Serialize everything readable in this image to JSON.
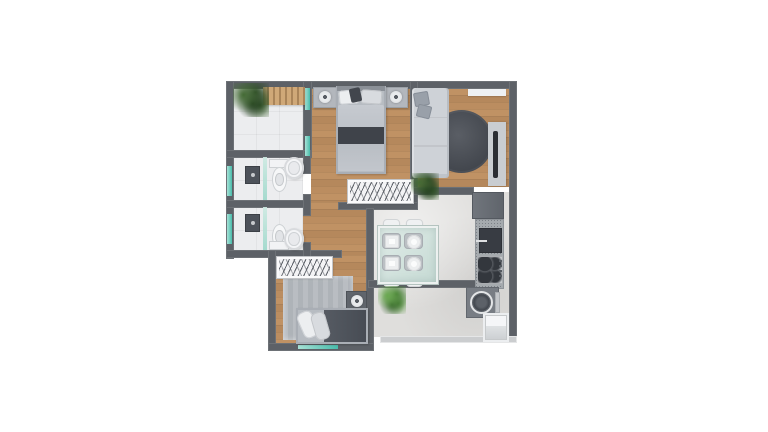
{
  "scene": {
    "background": "#ffffff",
    "kind": "apartment-floor-plan-3d-top-view"
  },
  "palette": {
    "wall": "#5d6167",
    "wall-light": "#cbcdcf",
    "wood-a": "#c09264",
    "wood-b": "#b5885c",
    "wood-c": "#bb8d60",
    "tile-white": "#ecedef",
    "tile-kitchen": "#dfdedc",
    "glass-a": "#a7e2d6",
    "glass-b": "#49bcac",
    "rug-dark-a": "#5a5e65",
    "rug-dark-b": "#41454c",
    "rug-light": "#b9bdc2",
    "sofa": "#ced2d7",
    "cushion": "#99a0a9",
    "bed-frame": "#b7bcc2",
    "bed-throw": "#3f434a",
    "bed2-duvet": "#565b63",
    "counter": "#a5aaae",
    "glass-table": "#c6dad4"
  },
  "rooms": [
    {
      "id": "balcony"
    },
    {
      "id": "bedroom-1"
    },
    {
      "id": "living-room"
    },
    {
      "id": "bathroom-1"
    },
    {
      "id": "bathroom-2"
    },
    {
      "id": "hallway"
    },
    {
      "id": "bedroom-2"
    },
    {
      "id": "kitchen-dining"
    },
    {
      "id": "service-area"
    }
  ],
  "plan": {
    "items": [
      {
        "id": "balcony-floor",
        "t": "floor-tile-white",
        "x": 233,
        "y": 88,
        "w": 72,
        "h": 64,
        "z": 1
      },
      {
        "id": "bathroom-1-floor",
        "t": "floor-tile-white",
        "x": 233,
        "y": 157,
        "w": 70,
        "h": 44,
        "z": 1
      },
      {
        "id": "bathroom-2-floor",
        "t": "floor-tile-white",
        "x": 233,
        "y": 207,
        "w": 70,
        "h": 44,
        "z": 1
      },
      {
        "id": "bedroom-1-floor",
        "t": "floor-wood",
        "x": 311,
        "y": 88,
        "w": 100,
        "h": 116,
        "z": 1
      },
      {
        "id": "living-room-floor",
        "t": "floor-wood",
        "x": 417,
        "y": 88,
        "w": 93,
        "h": 99,
        "z": 1
      },
      {
        "id": "hallway-floor",
        "t": "floor-wood",
        "x": 303,
        "y": 202,
        "w": 64,
        "h": 60,
        "z": 1
      },
      {
        "id": "bedroom-2-floor",
        "t": "floor-wood",
        "x": 275,
        "y": 255,
        "w": 92,
        "h": 90,
        "z": 1
      },
      {
        "id": "kitchen-floor",
        "t": "floor-tile-kitchen",
        "x": 374,
        "y": 192,
        "w": 136,
        "h": 145,
        "z": 1
      },
      {
        "id": "living-rug",
        "t": "rug-round",
        "x": 430,
        "y": 110,
        "w": 63,
        "h": 63,
        "r": "50%",
        "z": 2
      },
      {
        "id": "bedroom-2-rug",
        "t": "rug-flat",
        "x": 283,
        "y": 276,
        "w": 70,
        "h": 64,
        "z": 2
      },
      {
        "id": "wall-top",
        "t": "wall",
        "x": 226,
        "y": 81,
        "w": 291,
        "h": 8,
        "z": 3
      },
      {
        "id": "wall-left",
        "t": "wall",
        "x": 226,
        "y": 81,
        "w": 8,
        "h": 178,
        "z": 3
      },
      {
        "id": "wall-right",
        "t": "wall",
        "x": 509,
        "y": 81,
        "w": 8,
        "h": 262,
        "z": 3
      },
      {
        "id": "wall-balcony-divider",
        "t": "wall",
        "x": 303,
        "y": 81,
        "w": 9,
        "h": 77,
        "z": 3
      },
      {
        "id": "wall-balcony-bottom",
        "t": "wall",
        "x": 226,
        "y": 150,
        "w": 86,
        "h": 8,
        "z": 3
      },
      {
        "id": "wall-bath-divider",
        "t": "wall",
        "x": 226,
        "y": 200,
        "w": 84,
        "h": 8,
        "z": 3
      },
      {
        "id": "wall-bath2-bottom",
        "t": "wall",
        "x": 226,
        "y": 250,
        "w": 116,
        "h": 8,
        "z": 3
      },
      {
        "id": "wall-bath-right-a",
        "t": "wall",
        "x": 303,
        "y": 150,
        "w": 8,
        "h": 24,
        "z": 3
      },
      {
        "id": "wall-bath-right-b",
        "t": "wall",
        "x": 303,
        "y": 194,
        "w": 8,
        "h": 22,
        "z": 3
      },
      {
        "id": "wall-bath-right-c",
        "t": "wall",
        "x": 303,
        "y": 242,
        "w": 8,
        "h": 16,
        "z": 3
      },
      {
        "id": "wall-bedroom1-right",
        "t": "wall",
        "x": 410,
        "y": 81,
        "w": 8,
        "h": 129,
        "z": 3
      },
      {
        "id": "wall-bedroom1-bottom",
        "t": "wall",
        "x": 338,
        "y": 202,
        "w": 80,
        "h": 8,
        "z": 3
      },
      {
        "id": "wall-bedroom2-right",
        "t": "wall",
        "x": 366,
        "y": 208,
        "w": 8,
        "h": 143,
        "z": 3
      },
      {
        "id": "wall-bedroom2-left",
        "t": "wall",
        "x": 268,
        "y": 250,
        "w": 8,
        "h": 101,
        "z": 3
      },
      {
        "id": "wall-living-step",
        "t": "wall",
        "x": 412,
        "y": 187,
        "w": 62,
        "h": 8,
        "z": 3
      },
      {
        "id": "wall-kitchen-band",
        "t": "wall",
        "x": 368,
        "y": 280,
        "w": 110,
        "h": 8,
        "z": 3
      },
      {
        "id": "wall-bedroom2-bottom",
        "t": "wall",
        "x": 268,
        "y": 343,
        "w": 106,
        "h": 8,
        "z": 3
      },
      {
        "id": "wall-kitchen-bottom",
        "t": "wall-light",
        "x": 380,
        "y": 336,
        "w": 137,
        "h": 7,
        "z": 3
      },
      {
        "id": "bathroom-1-window",
        "t": "window-glass",
        "x": 227,
        "y": 166,
        "w": 5,
        "h": 30,
        "z": 4
      },
      {
        "id": "bathroom-2-window",
        "t": "window-glass",
        "x": 227,
        "y": 214,
        "w": 5,
        "h": 30,
        "z": 4
      },
      {
        "id": "bedroom-1-window-upper",
        "t": "window-glass",
        "x": 305,
        "y": 88,
        "w": 5,
        "h": 22,
        "z": 4
      },
      {
        "id": "bedroom-1-window-lower",
        "t": "window-glass",
        "x": 305,
        "y": 136,
        "w": 5,
        "h": 20,
        "z": 4
      },
      {
        "id": "bedroom-2-window",
        "t": "window-glass",
        "x": 298,
        "y": 345,
        "w": 40,
        "h": 4,
        "z": 4
      },
      {
        "id": "balcony-bench",
        "t": "bench-slats",
        "x": 263,
        "y": 87,
        "w": 42,
        "h": 18,
        "z": 5
      },
      {
        "id": "balcony-plant",
        "t": "plant-dark",
        "x": 233,
        "y": 83,
        "w": 36,
        "h": 34,
        "z": 5
      },
      {
        "id": "bedroom-1-nightstand-left",
        "t": "nightstand",
        "x": 313,
        "y": 87,
        "w": 24,
        "h": 21,
        "z": 5
      },
      {
        "id": "bedroom-1-lamp-left",
        "t": "lamp",
        "x": 319,
        "y": 91,
        "w": 12,
        "h": 12,
        "z": 6
      },
      {
        "id": "bedroom-1-nightstand-right",
        "t": "nightstand",
        "x": 384,
        "y": 87,
        "w": 24,
        "h": 21,
        "z": 5
      },
      {
        "id": "bedroom-1-lamp-right",
        "t": "lamp",
        "x": 390,
        "y": 91,
        "w": 12,
        "h": 12,
        "z": 6
      },
      {
        "id": "bedroom-1-bed",
        "t": "bed-frame",
        "x": 336,
        "y": 86,
        "w": 50,
        "h": 88,
        "z": 5
      },
      {
        "id": "bedroom-1-bed-headboard",
        "t": "headboard",
        "x": 337,
        "y": 86,
        "w": 48,
        "h": 5,
        "z": 6
      },
      {
        "id": "bedroom-1-pillow-left",
        "t": "pillow",
        "x": 339,
        "y": 90,
        "w": 20,
        "h": 14,
        "r": 3,
        "rot": -5,
        "z": 6
      },
      {
        "id": "bedroom-1-pillow-right",
        "t": "pillow-gray",
        "x": 361,
        "y": 90,
        "w": 21,
        "h": 14,
        "r": 3,
        "rot": 4,
        "z": 6
      },
      {
        "id": "bedroom-1-pillow-accent",
        "t": "pillow-dark",
        "x": 350,
        "y": 88,
        "w": 11,
        "h": 14,
        "r": 2,
        "rot": -12,
        "z": 7
      },
      {
        "id": "bedroom-1-duvet",
        "t": "duvet",
        "x": 338,
        "y": 105,
        "w": 46,
        "h": 66,
        "r": 2,
        "z": 6
      },
      {
        "id": "bedroom-1-throw",
        "t": "throw",
        "x": 338,
        "y": 127,
        "w": 46,
        "h": 17,
        "z": 7
      },
      {
        "id": "bedroom-1-wardrobe",
        "t": "wardrobe",
        "x": 348,
        "y": 180,
        "w": 65,
        "h": 23,
        "z": 5
      },
      {
        "id": "living-shelf",
        "t": "shelf",
        "x": 468,
        "y": 89,
        "w": 38,
        "h": 7,
        "z": 5
      },
      {
        "id": "living-sofa",
        "t": "sofa",
        "x": 412,
        "y": 88,
        "w": 37,
        "h": 90,
        "z": 5
      },
      {
        "id": "living-sofa-pillow-1",
        "t": "cushion",
        "x": 414,
        "y": 92,
        "w": 15,
        "h": 14,
        "r": 2,
        "rot": -10,
        "z": 6
      },
      {
        "id": "living-sofa-pillow-2",
        "t": "cushion",
        "x": 417,
        "y": 105,
        "w": 14,
        "h": 13,
        "r": 2,
        "rot": 14,
        "z": 6
      },
      {
        "id": "living-tv-panel",
        "t": "tv-panel",
        "x": 488,
        "y": 122,
        "w": 18,
        "h": 64,
        "z": 5
      },
      {
        "id": "living-tv-screen",
        "t": "tv-screen",
        "x": 493,
        "y": 131,
        "w": 5,
        "h": 47,
        "z": 6
      },
      {
        "id": "living-plant",
        "t": "plant-dark",
        "x": 411,
        "y": 173,
        "w": 28,
        "h": 27,
        "z": 6
      },
      {
        "id": "bathroom-1-shower-glass",
        "t": "shower-glass",
        "x": 263,
        "y": 157,
        "w": 4,
        "h": 43,
        "z": 5
      },
      {
        "id": "bathroom-1-shower-fixture",
        "t": "shower-fixture",
        "x": 245,
        "y": 166,
        "w": 15,
        "h": 18,
        "z": 5
      },
      {
        "id": "bathroom-1-toilet-tank",
        "t": "toilet-tank",
        "x": 269,
        "y": 159,
        "w": 20,
        "h": 9,
        "z": 5
      },
      {
        "id": "bathroom-1-toilet-bowl",
        "t": "toilet-bowl",
        "x": 272,
        "y": 167,
        "w": 15,
        "h": 25,
        "z": 5
      },
      {
        "id": "bathroom-1-sink",
        "t": "sink-oval",
        "x": 284,
        "y": 157,
        "w": 20,
        "h": 22,
        "z": 6
      },
      {
        "id": "bathroom-2-shower-glass",
        "t": "shower-glass",
        "x": 263,
        "y": 207,
        "w": 4,
        "h": 43,
        "z": 5
      },
      {
        "id": "bathroom-2-shower-fixture",
        "t": "shower-fixture",
        "x": 245,
        "y": 214,
        "w": 15,
        "h": 18,
        "z": 5
      },
      {
        "id": "bathroom-2-toilet-bowl",
        "t": "toilet-bowl",
        "x": 272,
        "y": 224,
        "w": 15,
        "h": 25,
        "z": 5
      },
      {
        "id": "bathroom-2-toilet-tank",
        "t": "toilet-tank",
        "x": 269,
        "y": 241,
        "w": 20,
        "h": 9,
        "z": 5
      },
      {
        "id": "bathroom-2-sink",
        "t": "sink-oval",
        "x": 284,
        "y": 228,
        "w": 20,
        "h": 22,
        "z": 6
      },
      {
        "id": "bedroom-2-wardrobe",
        "t": "wardrobe",
        "x": 277,
        "y": 257,
        "w": 55,
        "h": 21,
        "z": 5
      },
      {
        "id": "bedroom-2-nightstand",
        "t": "nightstand-dark",
        "x": 346,
        "y": 291,
        "w": 21,
        "h": 20,
        "z": 5
      },
      {
        "id": "bedroom-2-lamp",
        "t": "lamp",
        "x": 351,
        "y": 295,
        "w": 12,
        "h": 12,
        "z": 6
      },
      {
        "id": "bedroom-2-bed",
        "t": "bed-frame",
        "x": 296,
        "y": 308,
        "w": 72,
        "h": 36,
        "z": 5
      },
      {
        "id": "bedroom-2-duvet",
        "t": "duvet-dark",
        "x": 324,
        "y": 310,
        "w": 42,
        "h": 32,
        "z": 6
      },
      {
        "id": "bedroom-2-pillow-1",
        "t": "pillow",
        "x": 300,
        "y": 311,
        "w": 16,
        "h": 27,
        "r": 6,
        "rot": -24,
        "z": 6
      },
      {
        "id": "bedroom-2-pillow-2",
        "t": "pillow-gray",
        "x": 313,
        "y": 312,
        "w": 15,
        "h": 28,
        "r": 6,
        "rot": -16,
        "z": 6
      },
      {
        "id": "kitchen-fridge",
        "t": "fridge",
        "x": 472,
        "y": 192,
        "w": 32,
        "h": 27,
        "z": 5
      },
      {
        "id": "kitchen-counter",
        "t": "counter-speckle",
        "x": 475,
        "y": 219,
        "w": 29,
        "h": 70,
        "z": 5
      },
      {
        "id": "kitchen-sink",
        "t": "sink-dark",
        "x": 479,
        "y": 228,
        "w": 23,
        "h": 25,
        "z": 6
      },
      {
        "id": "kitchen-stove",
        "t": "stove",
        "x": 477,
        "y": 256,
        "w": 26,
        "h": 28,
        "z": 6
      },
      {
        "id": "kitchen-washer",
        "t": "washer",
        "x": 466,
        "y": 287,
        "w": 33,
        "h": 31,
        "z": 5
      },
      {
        "id": "kitchen-washer-drum",
        "t": "washer-drum",
        "x": 470,
        "y": 291,
        "w": 23,
        "h": 23,
        "z": 6
      },
      {
        "id": "kitchen-washer-panel",
        "t": "washer-panel",
        "x": 495,
        "y": 292,
        "w": 5,
        "h": 21,
        "z": 6
      },
      {
        "id": "kitchen-tank",
        "t": "tank-white",
        "x": 483,
        "y": 313,
        "w": 26,
        "h": 29,
        "z": 5
      },
      {
        "id": "dining-chair-top-left",
        "t": "chair",
        "x": 383,
        "y": 219,
        "w": 17,
        "h": 11,
        "z": 5
      },
      {
        "id": "dining-chair-top-right",
        "t": "chair",
        "x": 406,
        "y": 219,
        "w": 17,
        "h": 11,
        "z": 5
      },
      {
        "id": "dining-chair-bottom-left",
        "t": "chair",
        "x": 383,
        "y": 276,
        "w": 17,
        "h": 11,
        "z": 5
      },
      {
        "id": "dining-chair-bottom-right",
        "t": "chair",
        "x": 406,
        "y": 276,
        "w": 17,
        "h": 11,
        "z": 5
      },
      {
        "id": "dining-table",
        "t": "table-glass",
        "x": 378,
        "y": 226,
        "w": 60,
        "h": 58,
        "z": 6
      },
      {
        "id": "dining-seat-1",
        "t": "chair-seat",
        "x": 382,
        "y": 233,
        "w": 19,
        "h": 16,
        "z": 7
      },
      {
        "id": "dining-seat-2",
        "t": "chair-seat",
        "x": 382,
        "y": 255,
        "w": 19,
        "h": 16,
        "z": 7
      },
      {
        "id": "dining-seat-3",
        "t": "chair-seat",
        "x": 404,
        "y": 233,
        "w": 19,
        "h": 16,
        "z": 7
      },
      {
        "id": "dining-seat-4",
        "t": "chair-seat",
        "x": 404,
        "y": 255,
        "w": 19,
        "h": 16,
        "z": 7
      },
      {
        "id": "dining-plate-square-1",
        "t": "plate-square",
        "x": 385,
        "y": 235,
        "w": 14,
        "h": 13,
        "z": 8
      },
      {
        "id": "dining-plate-square-2",
        "t": "plate-square",
        "x": 385,
        "y": 257,
        "w": 14,
        "h": 13,
        "z": 8
      },
      {
        "id": "dining-plate-round-1",
        "t": "plate-round",
        "x": 407,
        "y": 235,
        "w": 14,
        "h": 14,
        "z": 8
      },
      {
        "id": "dining-plate-round-2",
        "t": "plate-round",
        "x": 407,
        "y": 257,
        "w": 14,
        "h": 14,
        "z": 8
      },
      {
        "id": "dining-plant",
        "t": "plant-bright",
        "x": 378,
        "y": 286,
        "w": 28,
        "h": 28,
        "z": 8
      }
    ]
  }
}
